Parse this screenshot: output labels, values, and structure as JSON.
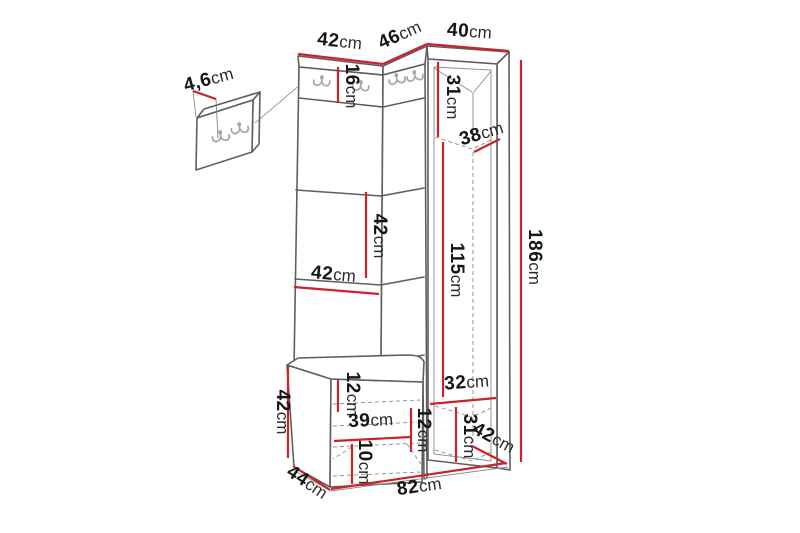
{
  "colors": {
    "dimension": "#cc2229",
    "outline": "#5f5f5f",
    "outline-light": "#8c8c8c",
    "hook": "#a6a6a6",
    "background": "#ffffff"
  },
  "dimensions": {
    "detail_panel_depth": {
      "value": "4,6",
      "unit": "cm"
    },
    "top_width_left": {
      "value": "42",
      "unit": "cm"
    },
    "top_width_middle": {
      "value": "46",
      "unit": "cm"
    },
    "top_width_right": {
      "value": "40",
      "unit": "cm"
    },
    "hook_strip_height": {
      "value": "16",
      "unit": "cm"
    },
    "corner_upper_height": {
      "value": "31",
      "unit": "cm"
    },
    "corner_shelf_depth": {
      "value": "38",
      "unit": "cm"
    },
    "panel_section_height": {
      "value": "42",
      "unit": "cm"
    },
    "panel_section_width": {
      "value": "42",
      "unit": "cm"
    },
    "corner_lower_height": {
      "value": "115",
      "unit": "cm"
    },
    "total_height": {
      "value": "186",
      "unit": "cm"
    },
    "bench_height": {
      "value": "42",
      "unit": "cm"
    },
    "bench_top_gap": {
      "value": "12",
      "unit": "cm"
    },
    "bench_inner_width": {
      "value": "39",
      "unit": "cm"
    },
    "bench_right_gap": {
      "value": "12",
      "unit": "cm"
    },
    "bench_bottom_gap": {
      "value": "10",
      "unit": "cm"
    },
    "corner_bottom_width": {
      "value": "32",
      "unit": "cm"
    },
    "corner_bottom_height": {
      "value": "31",
      "unit": "cm"
    },
    "corner_depth": {
      "value": "42",
      "unit": "cm"
    },
    "bench_depth": {
      "value": "44",
      "unit": "cm"
    },
    "total_width": {
      "value": "82",
      "unit": "cm"
    }
  }
}
